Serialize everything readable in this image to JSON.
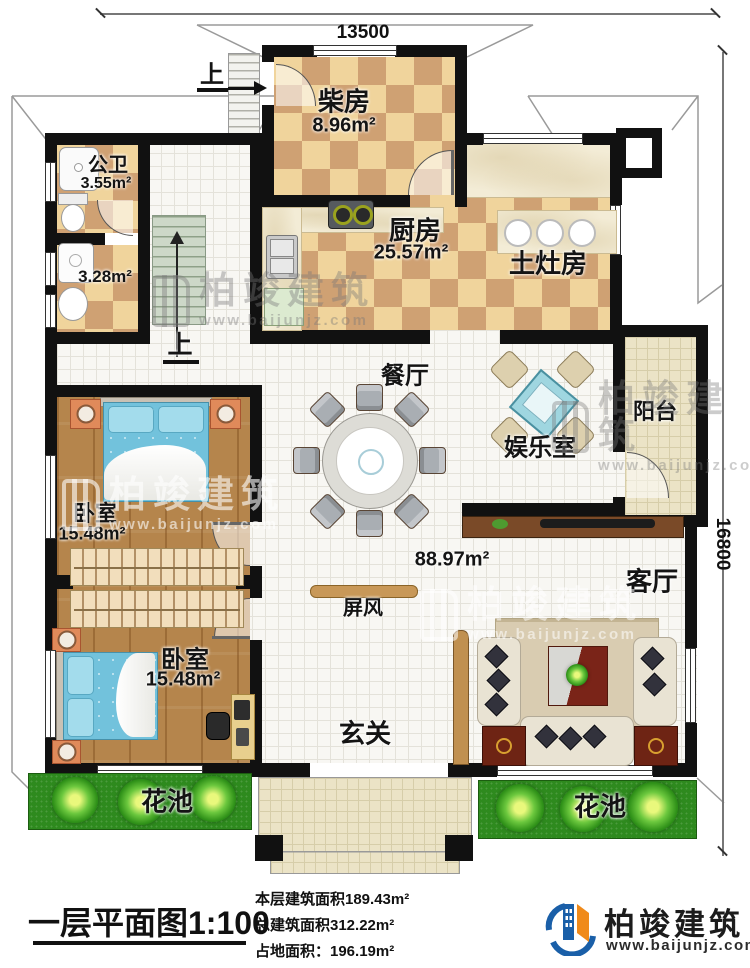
{
  "dimensions": {
    "width_label": "13500",
    "height_label": "16800"
  },
  "rooms": {
    "chaifang": {
      "label": "柴房",
      "area": "8.96m²"
    },
    "gongwei": {
      "label": "公卫",
      "area": "3.55m²"
    },
    "xishoujian": {
      "area": "3.28m²"
    },
    "chufang": {
      "label": "厨房",
      "area": "25.57m²"
    },
    "tuzaofang": {
      "label": "土灶房"
    },
    "canting": {
      "label": "餐厅"
    },
    "yuleshi": {
      "label": "娱乐室"
    },
    "yangtai": {
      "label": "阳台"
    },
    "woshi1": {
      "label": "卧室",
      "area": "15.48m²"
    },
    "woshi2": {
      "label": "卧室",
      "area": "15.48m²"
    },
    "keting": {
      "label": "客厅"
    },
    "xuanguan": {
      "label": "玄关"
    },
    "pingfeng": {
      "label": "屏风"
    },
    "huachi_left": {
      "label": "花池"
    },
    "huachi_right": {
      "label": "花池"
    },
    "hall": {
      "area": "88.97m²"
    }
  },
  "stairs": {
    "up_label": "上"
  },
  "footer": {
    "title": "一层平面图1:100",
    "floor_area": "本层建筑面积189.43m²",
    "total_area": "总建筑面积312.22m²",
    "land_area": "占地面积：196.19m²"
  },
  "logo": {
    "brand": "柏竣建筑",
    "website": "www.baijunjz.com"
  },
  "watermark": {
    "brand": "柏竣建筑",
    "website": "www.baijunjz.com"
  }
}
